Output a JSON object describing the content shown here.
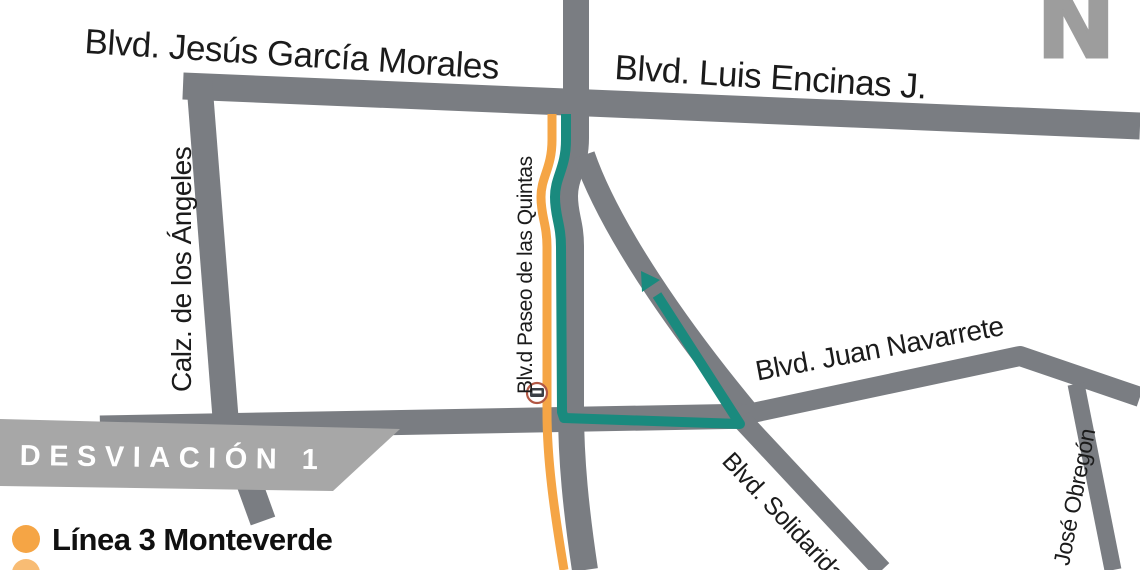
{
  "map": {
    "north_indicator": "N",
    "streets": {
      "jesus_garcia_morales": "Blvd. Jesús García Morales",
      "luis_encinas": "Blvd. Luis Encinas J.",
      "calz_angeles": "Calz. de los Ángeles",
      "paseo_quintas": "Blv.d Paseo de las Quintas",
      "juan_navarrete": "Blvd. Juan Navarrete",
      "solidaridad": "Blvd. Solidaridad",
      "jose_obregon": ". José Obregón"
    },
    "colors": {
      "street": "#7A7D82",
      "route_line3": "#F5A545",
      "route_detour": "#1A8A7E",
      "banner": "#A7A7A7",
      "north": "#9D9D9D",
      "stop_ring": "#B25744",
      "stop_glyph": "#3A3F46"
    }
  },
  "banner": {
    "title": "DESVIACIÓN 1"
  },
  "legend": {
    "items": [
      {
        "label": "Línea 3 Monteverde",
        "color": "#F5A545"
      },
      {
        "label": "",
        "color": "#F5A545"
      }
    ]
  }
}
